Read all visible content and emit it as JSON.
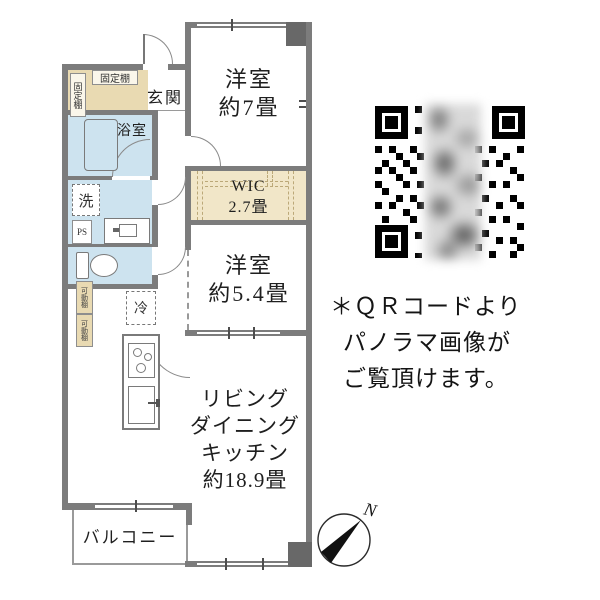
{
  "floor_plan": {
    "rooms": {
      "western7": {
        "name": "洋室",
        "size": "約7畳"
      },
      "wic": {
        "name": "WIC",
        "size": "2.7畳"
      },
      "western54": {
        "name": "洋室",
        "size": "約5.4畳"
      },
      "ldk": {
        "line1": "リビング",
        "line2": "ダイニング",
        "line3": "キッチン",
        "line4": "約18.9畳"
      },
      "entrance": "玄関",
      "bathroom": "浴室",
      "balcony": "バルコニー"
    },
    "labels": {
      "washer": "洗",
      "pipe_space": "PS",
      "fridge": "冷",
      "fixed_shelf_left": "固定棚",
      "fixed_shelf_top": "固定棚",
      "movable_shelf_upper": "可動棚",
      "movable_shelf_lower": "可動棚"
    },
    "compass_north": "N"
  },
  "qr_panel": {
    "line1": "＊ＱＲコードより",
    "line2": "パノラマ画像が",
    "line3": "ご覧頂けます。"
  },
  "colors": {
    "wall": "#7c7c7c",
    "pillar": "#686868",
    "water_area_blue": "#cde3ef",
    "shelf_beige": "#e9dab2",
    "wic_beige": "#f1e6c8"
  }
}
